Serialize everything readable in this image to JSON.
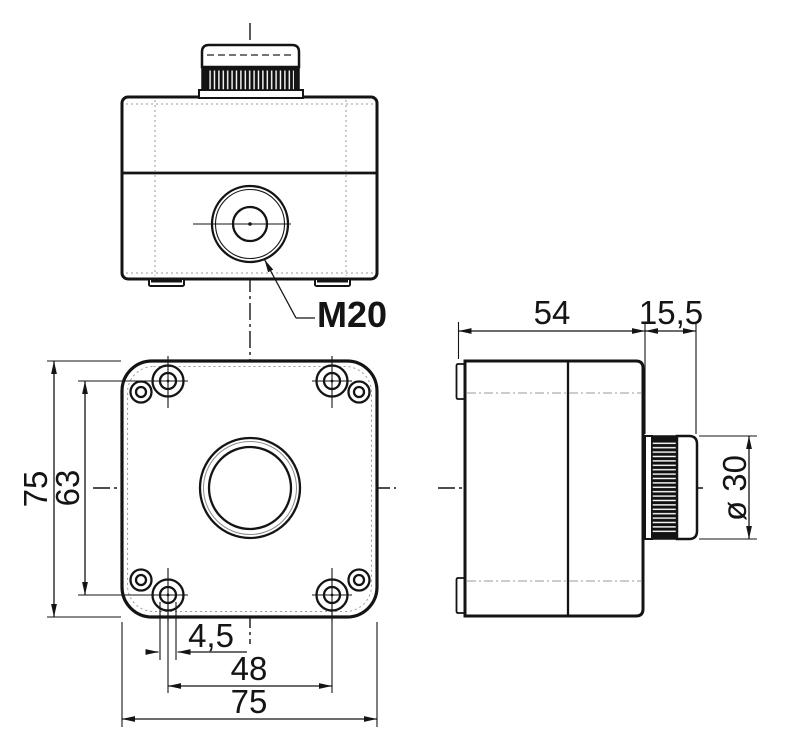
{
  "colors": {
    "ink": "#141414",
    "faint": "#9a9a9a",
    "background": "#ffffff"
  },
  "views": {
    "elevation": {
      "callout": {
        "label": "M20"
      }
    },
    "side": {
      "dims": {
        "body_depth": "54",
        "button_protrusion": "15,5",
        "button_diameter": "ø 30"
      }
    },
    "face": {
      "dims": {
        "overall_height": "75",
        "hole_spacing_vertical": "63",
        "slot_width": "4,5",
        "hole_spacing_horizontal": "48",
        "overall_width": "75"
      }
    }
  }
}
